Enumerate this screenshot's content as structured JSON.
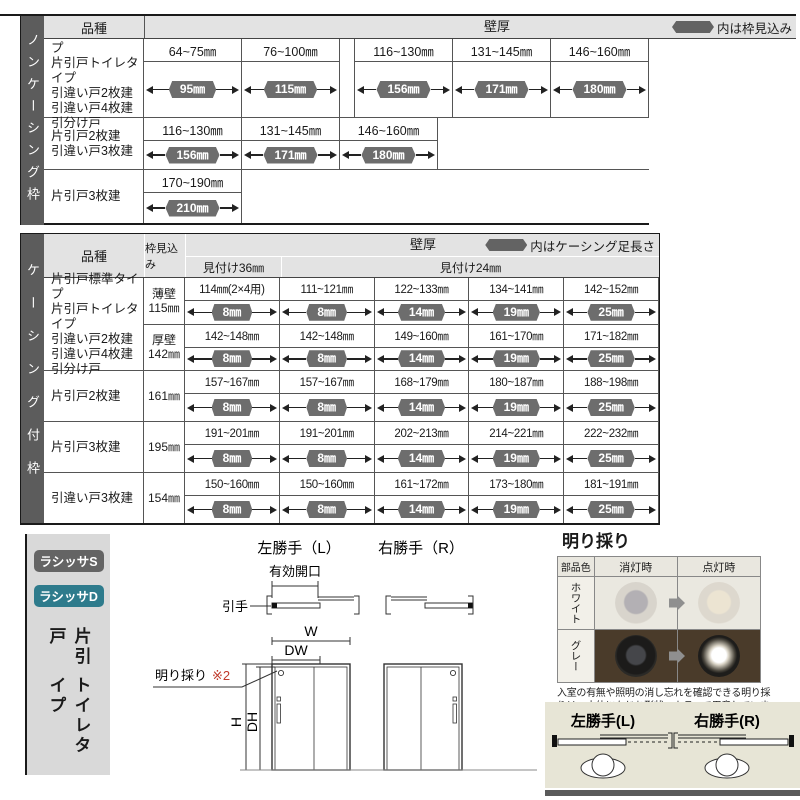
{
  "colors": {
    "sidebar_dark": "#5c5c5c",
    "header_gray": "#e3e3e3",
    "pill_gray": "#6d6d6d",
    "accent_teal": "#2e7b8c",
    "panel_gray": "#d9d9d9",
    "panel_beige": "#e7e5d6",
    "photo_brown": "#4a3b2a",
    "note_red": "#c0392b"
  },
  "table1": {
    "sidebar": "ノンケーシング枠",
    "col_kind": "品種",
    "col_wall": "壁厚",
    "note": "内は枠見込み",
    "rows": [
      {
        "products": [
          "片引戸標準タイプ",
          "片引戸トイレタイプ",
          "引違い戸2枚建",
          "引違い戸4枚建",
          "引分け戸"
        ],
        "cells": [
          {
            "range": "64~75㎜",
            "value": "95㎜"
          },
          {
            "range": "76~100㎜",
            "value": "115㎜"
          },
          {
            "range": "116~130㎜",
            "value": "156㎜"
          },
          {
            "range": "131~145㎜",
            "value": "171㎜"
          },
          {
            "range": "146~160㎜",
            "value": "180㎜"
          }
        ]
      },
      {
        "products": [
          "片引戸2枚建",
          "引違い戸3枚建"
        ],
        "cells": [
          {
            "range": "116~130㎜",
            "value": "156㎜"
          },
          {
            "range": "131~145㎜",
            "value": "171㎜"
          },
          {
            "range": "146~160㎜",
            "value": "180㎜"
          }
        ]
      },
      {
        "products": [
          "片引戸3枚建"
        ],
        "cells": [
          {
            "range": "170~190㎜",
            "value": "210㎜"
          }
        ]
      }
    ]
  },
  "table2": {
    "sidebar": "ケーシング付枠",
    "col_kind": "品種",
    "col_mikomi": "枠見込み",
    "col_wall": "壁厚",
    "note": "内はケーシング足長さ",
    "sub36": "見付け36㎜",
    "sub24": "見付け24㎜",
    "group1": {
      "products": [
        "片引戸標準タイプ",
        "片引戸トイレタイプ",
        "引違い戸2枚建",
        "引違い戸4枚建",
        "引分け戸"
      ],
      "subrows": [
        {
          "mikomi": [
            "薄壁",
            "115㎜"
          ],
          "cells": [
            {
              "range": "114㎜(2×4用)",
              "value": "8㎜"
            },
            {
              "range": "111~121㎜",
              "value": "8㎜"
            },
            {
              "range": "122~133㎜",
              "value": "14㎜"
            },
            {
              "range": "134~141㎜",
              "value": "19㎜"
            },
            {
              "range": "142~152㎜",
              "value": "25㎜"
            }
          ]
        },
        {
          "mikomi": [
            "厚壁",
            "142㎜"
          ],
          "cells": [
            {
              "range": "142~148㎜",
              "value": "8㎜"
            },
            {
              "range": "142~148㎜",
              "value": "8㎜"
            },
            {
              "range": "149~160㎜",
              "value": "14㎜"
            },
            {
              "range": "161~170㎜",
              "value": "19㎜"
            },
            {
              "range": "171~182㎜",
              "value": "25㎜"
            }
          ]
        }
      ]
    },
    "rows": [
      {
        "product": "片引戸2枚建",
        "mikomi": "161㎜",
        "cells": [
          {
            "range": "157~167㎜",
            "value": "8㎜"
          },
          {
            "range": "157~167㎜",
            "value": "8㎜"
          },
          {
            "range": "168~179㎜",
            "value": "14㎜"
          },
          {
            "range": "180~187㎜",
            "value": "19㎜"
          },
          {
            "range": "188~198㎜",
            "value": "25㎜"
          }
        ]
      },
      {
        "product": "片引戸3枚建",
        "mikomi": "195㎜",
        "cells": [
          {
            "range": "191~201㎜",
            "value": "8㎜"
          },
          {
            "range": "191~201㎜",
            "value": "8㎜"
          },
          {
            "range": "202~213㎜",
            "value": "14㎜"
          },
          {
            "range": "214~221㎜",
            "value": "19㎜"
          },
          {
            "range": "222~232㎜",
            "value": "25㎜"
          }
        ]
      },
      {
        "product": "引違い戸3枚建",
        "mikomi": "154㎜",
        "cells": [
          {
            "range": "150~160㎜",
            "value": "8㎜"
          },
          {
            "range": "150~160㎜",
            "value": "8㎜"
          },
          {
            "range": "161~172㎜",
            "value": "14㎜"
          },
          {
            "range": "173~180㎜",
            "value": "19㎜"
          },
          {
            "range": "181~191㎜",
            "value": "25㎜"
          }
        ]
      }
    ]
  },
  "bottom": {
    "badges": {
      "s": "ラシッサS",
      "d": "ラシッサD"
    },
    "product_vertical": [
      "片引戸",
      "トイレタイプ"
    ],
    "diagram": {
      "left_title": "左勝手（L）",
      "right_title": "右勝手（R）",
      "opening": "有効開口",
      "handle": "引手",
      "w": "W",
      "dw": "DW",
      "h": "H",
      "dh": "DH",
      "akari_label": "明り採り",
      "note_ref": "※2"
    },
    "akari": {
      "title": "明り採り",
      "col_color": "部品色",
      "col_off": "消灯時",
      "col_on": "点灯時",
      "row_white": "ホワイト",
      "row_gray": "グレー",
      "caption": [
        "入室の有無や照明の消し忘れを確認できる明り採",
        "りは、本体になじむ形状・カラーで用意しています。"
      ]
    },
    "hand_panel": {
      "left": "左勝手(L)",
      "right": "右勝手(R)"
    }
  }
}
